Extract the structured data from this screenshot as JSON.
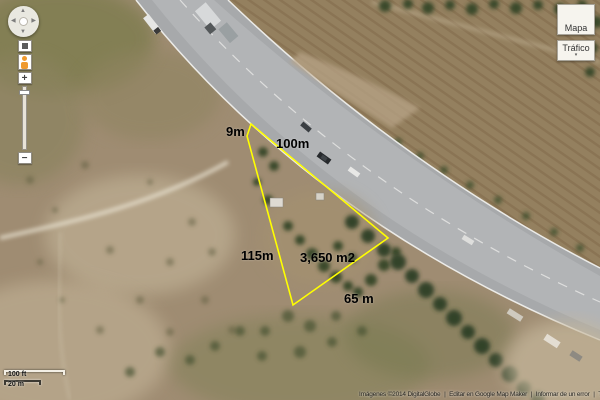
{
  "parcel": {
    "labels": [
      {
        "name": "side-9m",
        "text": "9m"
      },
      {
        "name": "side-100m",
        "text": "100m"
      },
      {
        "name": "side-115m",
        "text": "115m"
      },
      {
        "name": "area",
        "text": "3,650 m2"
      },
      {
        "name": "side-65m",
        "text": "65 m"
      }
    ]
  },
  "controls": {
    "pan": {
      "up": "▲",
      "down": "▼",
      "left": "◀",
      "right": "▶"
    },
    "zoom_in": "+",
    "zoom_out": "−"
  },
  "map_type_bar": {
    "mapa_label": "Mapa",
    "trafico_label": "Tráfico",
    "trafico_caret": "▾"
  },
  "scale": {
    "imperial": "100 ft",
    "metric": "20 m"
  },
  "attribution": {
    "imagery": "Imágenes ©2014 DigitalGlobe",
    "separator": "|",
    "edit_link": "Editar en Google Map Maker",
    "report_link": "Informar de un error",
    "terms_truncated": "T"
  },
  "colors": {
    "parcel_outline": "#ffff00",
    "pegman": "#ef9a2e"
  }
}
